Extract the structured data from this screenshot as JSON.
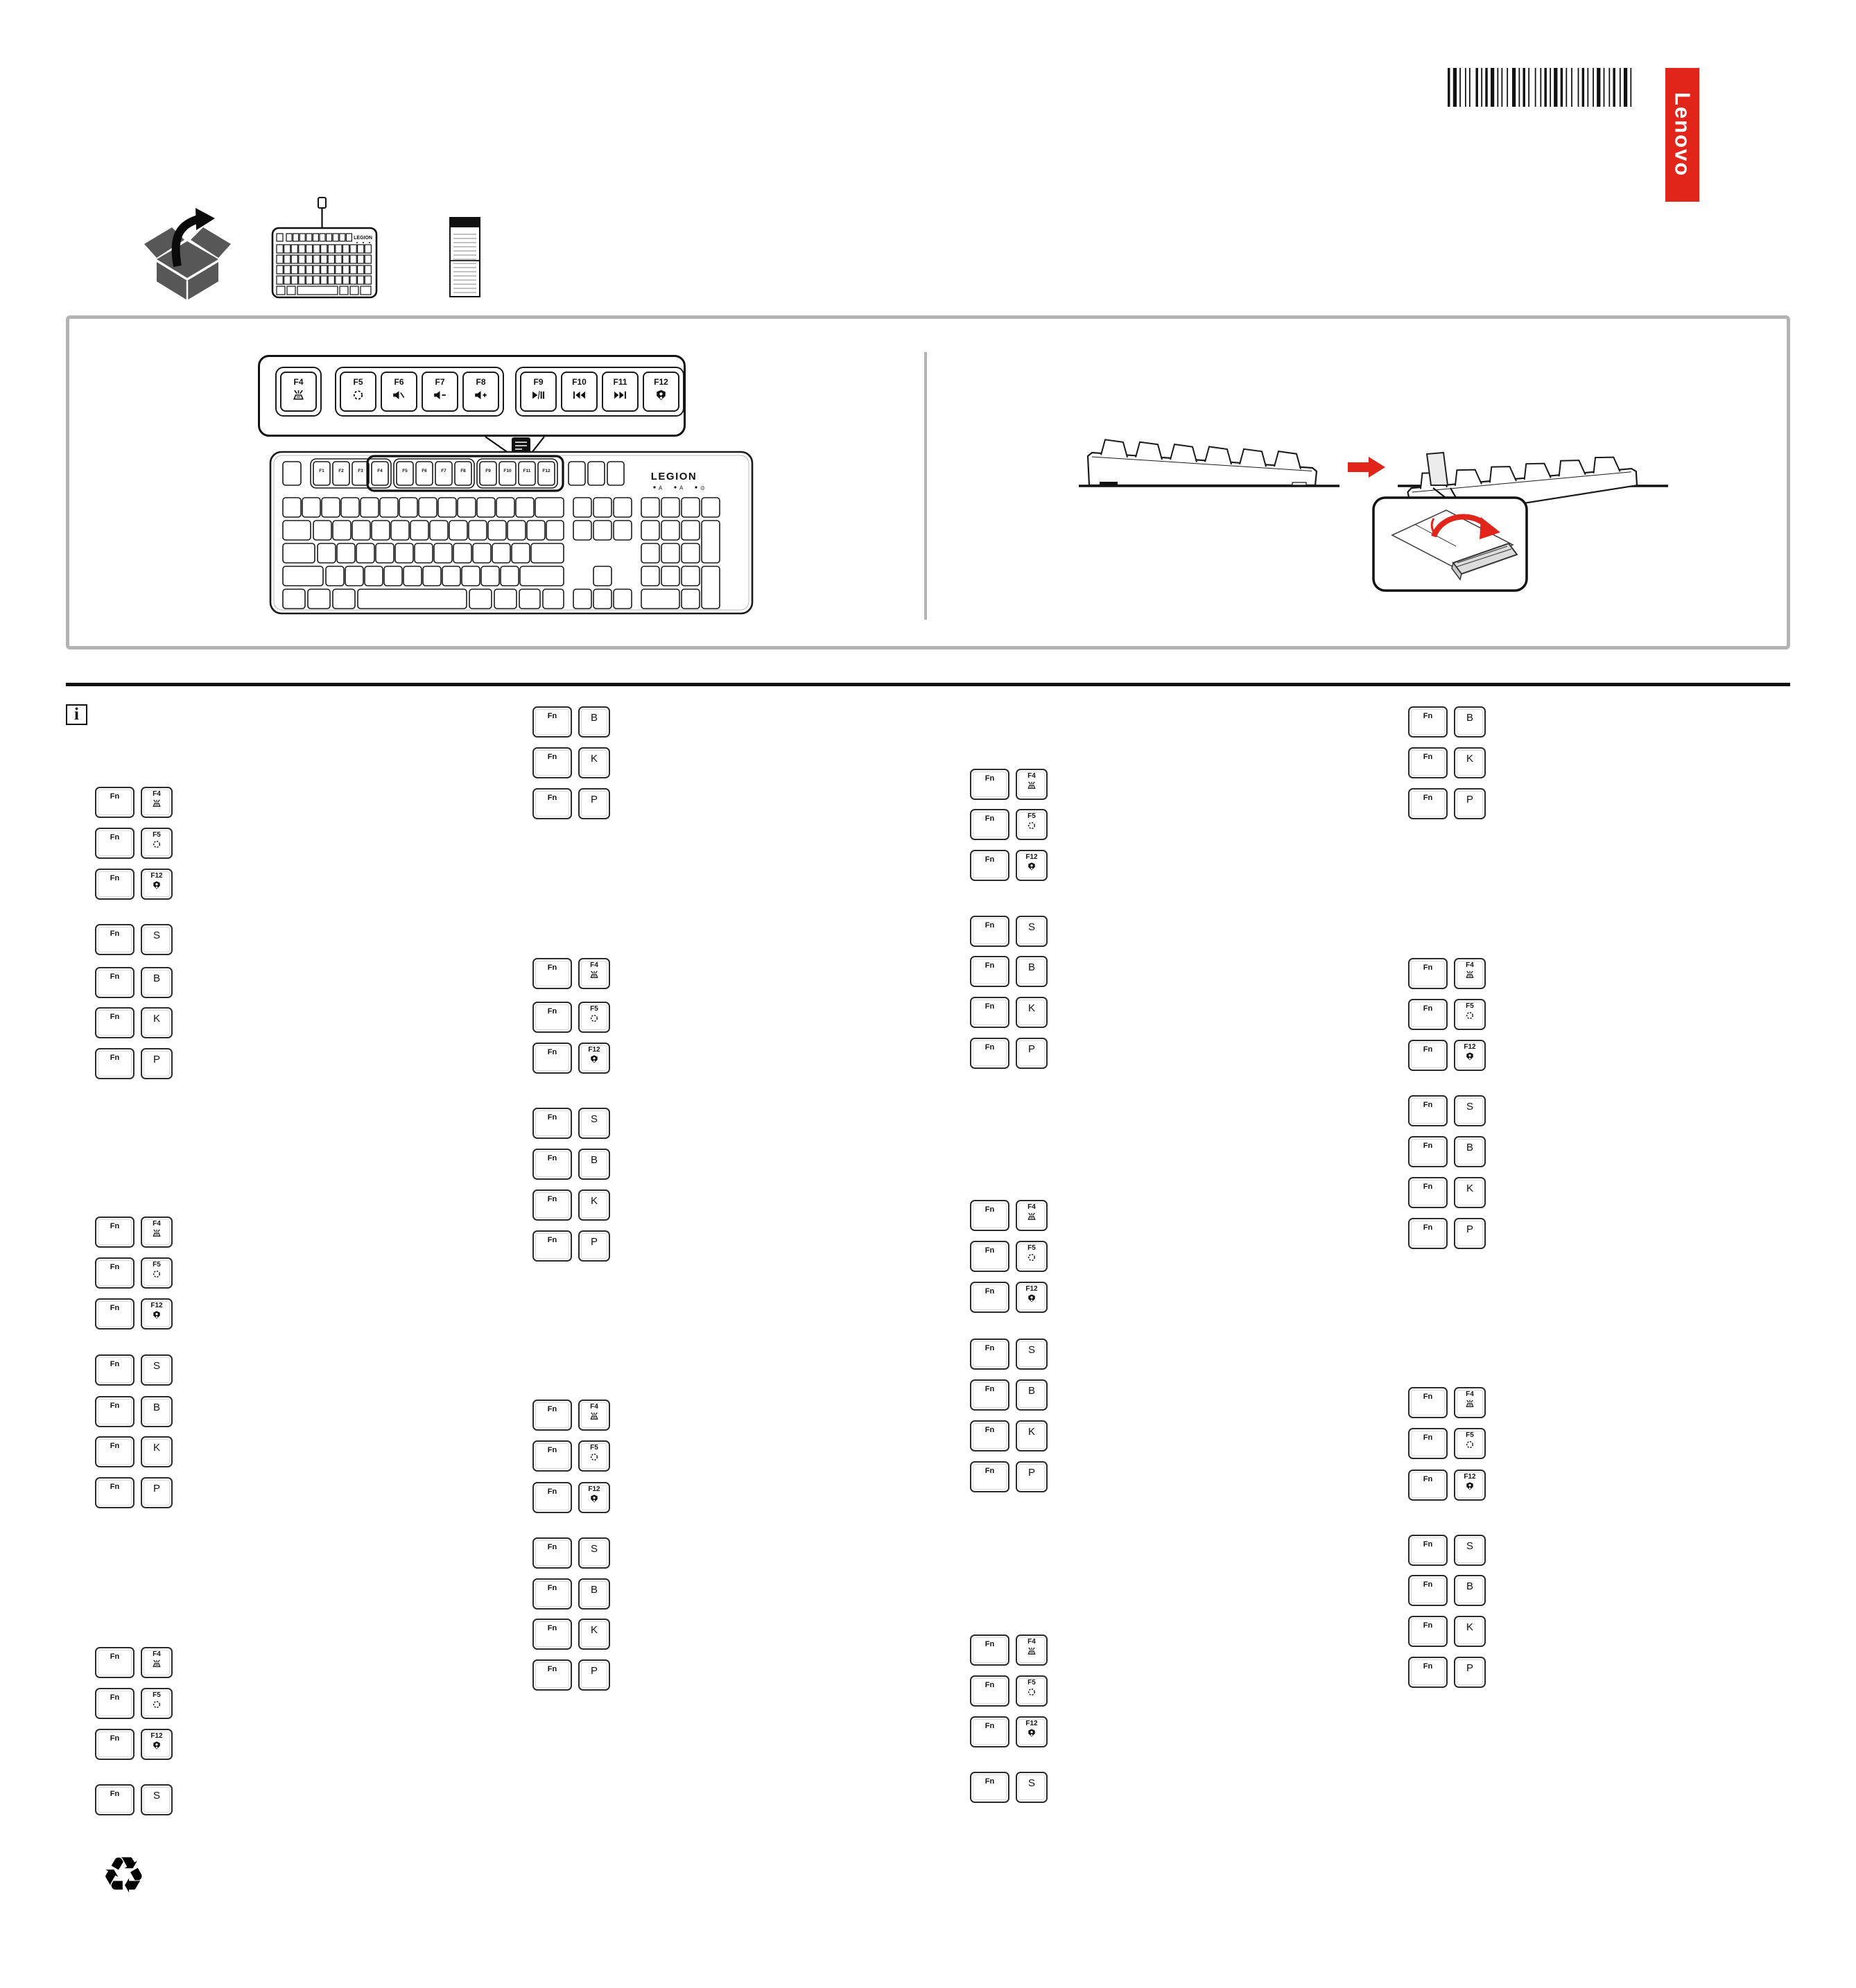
{
  "branding": {
    "lenovo_logo_text": "Lenovo",
    "keyboard_brand": "LEGION"
  },
  "colors": {
    "accent_red": "#E1251B",
    "line_black": "#1a1a1a",
    "panel_border_gray": "#b3b3b3",
    "icon_gray": "#575757"
  },
  "top_icons": {
    "unbox": "unbox-icon",
    "keyboard": "keyboard-illustration-icon",
    "manual": "document-icon",
    "barcode": "barcode"
  },
  "function_key_callout": {
    "keys": [
      {
        "label": "F4",
        "icon": "backlight-icon"
      },
      {
        "label": "F5",
        "icon": "light-effect-cycle-icon"
      },
      {
        "label": "F6",
        "icon": "mute-icon"
      },
      {
        "label": "F7",
        "icon": "volume-down-icon"
      },
      {
        "label": "F8",
        "icon": "volume-up-icon"
      },
      {
        "label": "F9",
        "icon": "play-pause-icon"
      },
      {
        "label": "F10",
        "icon": "previous-track-icon"
      },
      {
        "label": "F11",
        "icon": "next-track-icon"
      },
      {
        "label": "F12",
        "icon": "legion-logo-icon"
      }
    ]
  },
  "keyboard_illustration": {
    "f_keys": [
      "F1",
      "F2",
      "F3",
      "F4",
      "F5",
      "F6",
      "F7",
      "F8",
      "F9",
      "F10",
      "F11",
      "F12"
    ],
    "indicators": [
      "A",
      "A",
      "⊙"
    ]
  },
  "tilt_section": {
    "arrow_icon": "right-arrow-icon",
    "foot_callout": "flip-out-foot-illustration"
  },
  "info_section": {
    "info_icon_label": "i",
    "fn_label": "Fn",
    "columns": [
      {
        "keys": [
          {
            "label": "F4",
            "icon": "backlight-icon"
          },
          {
            "label": "F5",
            "icon": "light-effect-cycle-icon"
          },
          {
            "label": "F12",
            "icon": "legion-logo-icon"
          },
          {
            "label": "S"
          },
          {
            "label": "B"
          },
          {
            "label": "K"
          },
          {
            "label": "P"
          },
          {
            "label": "F4",
            "icon": "backlight-icon"
          },
          {
            "label": "F5",
            "icon": "light-effect-cycle-icon"
          },
          {
            "label": "F12",
            "icon": "legion-logo-icon"
          },
          {
            "label": "S"
          },
          {
            "label": "B"
          },
          {
            "label": "K"
          },
          {
            "label": "P"
          },
          {
            "label": "F4",
            "icon": "backlight-icon"
          },
          {
            "label": "F5",
            "icon": "light-effect-cycle-icon"
          },
          {
            "label": "F12",
            "icon": "legion-logo-icon"
          },
          {
            "label": "S"
          }
        ]
      },
      {
        "keys": [
          {
            "label": "B"
          },
          {
            "label": "K"
          },
          {
            "label": "P"
          },
          {
            "label": "F4",
            "icon": "backlight-icon"
          },
          {
            "label": "F5",
            "icon": "light-effect-cycle-icon"
          },
          {
            "label": "F12",
            "icon": "legion-logo-icon"
          },
          {
            "label": "S"
          },
          {
            "label": "B"
          },
          {
            "label": "K"
          },
          {
            "label": "P"
          },
          {
            "label": "F4",
            "icon": "backlight-icon"
          },
          {
            "label": "F5",
            "icon": "light-effect-cycle-icon"
          },
          {
            "label": "F12",
            "icon": "legion-logo-icon"
          },
          {
            "label": "S"
          },
          {
            "label": "B"
          },
          {
            "label": "K"
          },
          {
            "label": "P"
          }
        ]
      },
      {
        "keys": [
          {
            "label": "F4",
            "icon": "backlight-icon"
          },
          {
            "label": "F5",
            "icon": "light-effect-cycle-icon"
          },
          {
            "label": "F12",
            "icon": "legion-logo-icon"
          },
          {
            "label": "S"
          },
          {
            "label": "B"
          },
          {
            "label": "K"
          },
          {
            "label": "P"
          },
          {
            "label": "F4",
            "icon": "backlight-icon"
          },
          {
            "label": "F5",
            "icon": "light-effect-cycle-icon"
          },
          {
            "label": "F12",
            "icon": "legion-logo-icon"
          },
          {
            "label": "S"
          },
          {
            "label": "B"
          },
          {
            "label": "K"
          },
          {
            "label": "P"
          },
          {
            "label": "F4",
            "icon": "backlight-icon"
          },
          {
            "label": "F5",
            "icon": "light-effect-cycle-icon"
          },
          {
            "label": "F12",
            "icon": "legion-logo-icon"
          },
          {
            "label": "S"
          }
        ]
      },
      {
        "keys": [
          {
            "label": "B"
          },
          {
            "label": "K"
          },
          {
            "label": "P"
          },
          {
            "label": "F4",
            "icon": "backlight-icon"
          },
          {
            "label": "F5",
            "icon": "light-effect-cycle-icon"
          },
          {
            "label": "F12",
            "icon": "legion-logo-icon"
          },
          {
            "label": "S"
          },
          {
            "label": "B"
          },
          {
            "label": "K"
          },
          {
            "label": "P"
          },
          {
            "label": "F4",
            "icon": "backlight-icon"
          },
          {
            "label": "F5",
            "icon": "light-effect-cycle-icon"
          },
          {
            "label": "F12",
            "icon": "legion-logo-icon"
          },
          {
            "label": "S"
          },
          {
            "label": "B"
          },
          {
            "label": "K"
          },
          {
            "label": "P"
          }
        ]
      }
    ]
  },
  "footer": {
    "recycle_icon_glyph": "♻"
  }
}
